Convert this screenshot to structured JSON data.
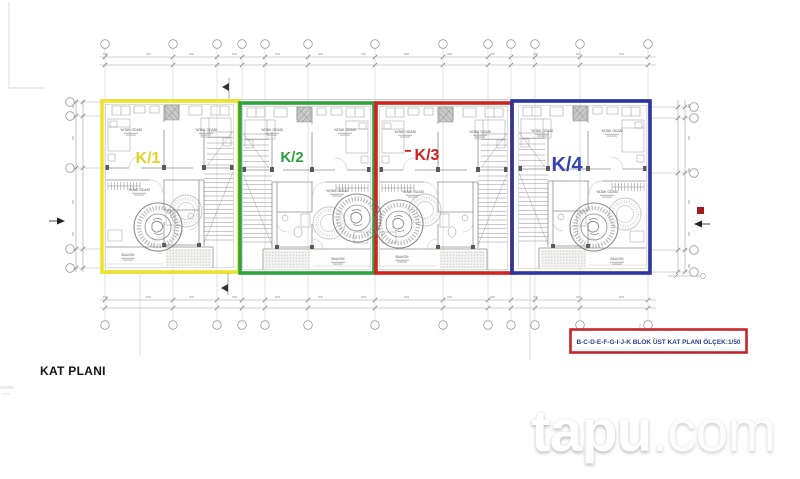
{
  "footer": {
    "title": "KAT PLANI"
  },
  "watermark": {
    "bold": "tapu",
    "light": ".com"
  },
  "plan": {
    "units": [
      {
        "name": "K/1",
        "outline_color": "#ece42d",
        "label_color": "#e3d21f"
      },
      {
        "name": "K/2",
        "outline_color": "#2fa33c",
        "label_color": "#2aa23c"
      },
      {
        "name": "K/3",
        "outline_color": "#d2231d",
        "label_color": "#d02019"
      },
      {
        "name": "K/4",
        "outline_color": "#2c35a0",
        "label_color": "#3445b0"
      }
    ],
    "room_labels": {
      "bedroom": "YATAK ODASI",
      "balcony": "BALKON"
    },
    "legend": {
      "text": "B-C-D-E-F-G-I-J-K BLOK ÜST KAT PLANI ÖLÇEK:1/50",
      "border_color": "#c8242a",
      "text_color": "#2c3f8f"
    }
  }
}
